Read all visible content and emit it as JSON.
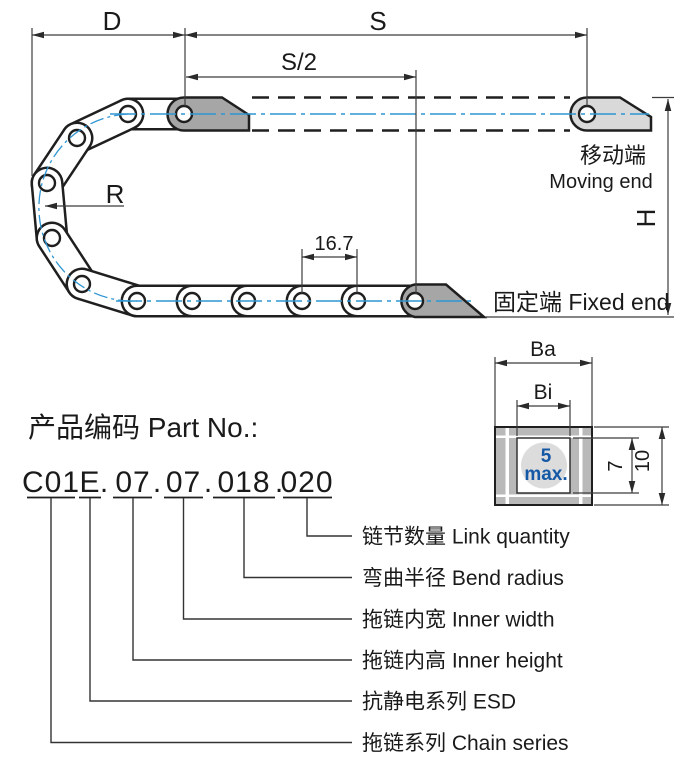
{
  "diagram": {
    "dim_d": "D",
    "dim_s": "S",
    "dim_s_half": "S/2",
    "dim_r": "R",
    "dim_h": "H",
    "pitch": "16.7",
    "moving_end_cn": "移动端",
    "moving_end_en": "Moving end",
    "fixed_end": "固定端 Fixed end",
    "colors": {
      "centerline_blue": "#2f96d2",
      "note_blue": "#1458a6",
      "bracket_dark": "#a6a6a6",
      "bracket_light": "#d9d9d9",
      "section_gray": "#b9b9b9"
    }
  },
  "section": {
    "outer_width": "Ba",
    "inner_width": "Bi",
    "note_value": "5",
    "note_unit": "max.",
    "inner_height": "7",
    "outer_height": "10"
  },
  "part_no": {
    "heading": "产品编码 Part No.:",
    "separator": ".",
    "segments": [
      "C01",
      "E",
      "07",
      "07",
      "018",
      "020"
    ],
    "labels": [
      "链节数量 Link quantity",
      "弯曲半径 Bend radius",
      "拖链内宽 Inner width",
      "拖链内高 Inner height",
      "抗静电系列 ESD",
      "拖链系列 Chain series"
    ]
  }
}
